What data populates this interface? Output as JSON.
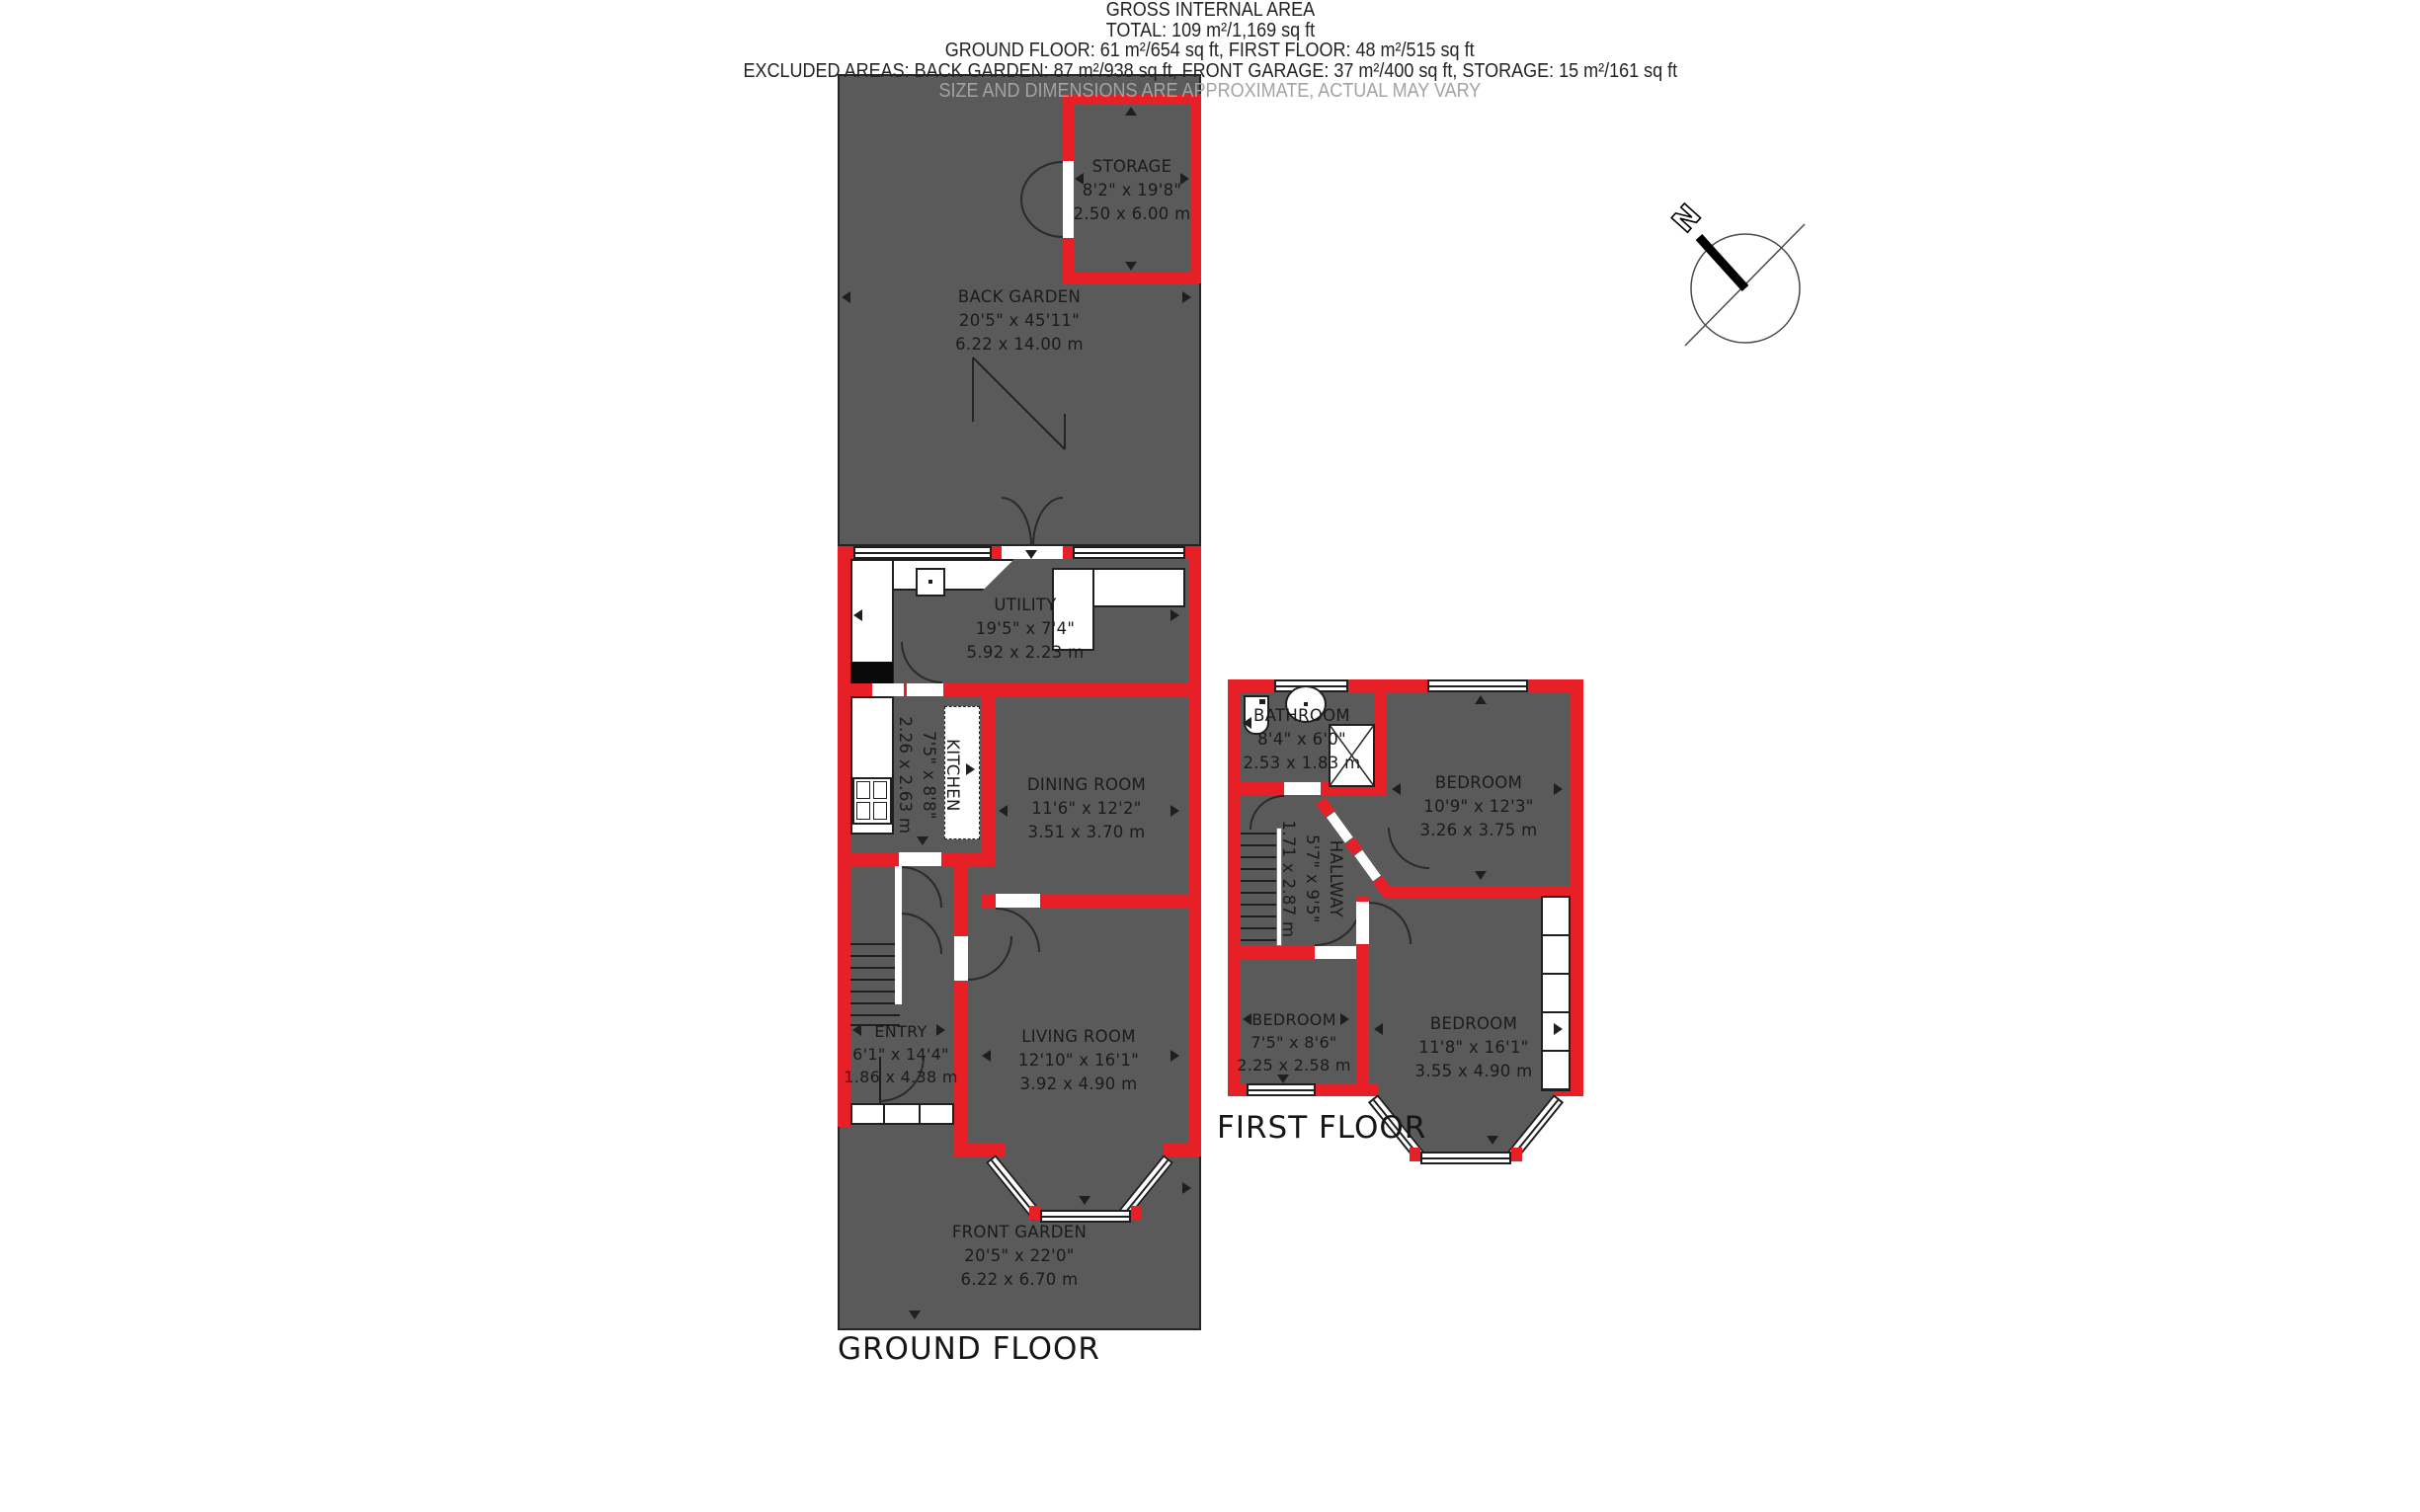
{
  "titles": {
    "ground_floor": "GROUND FLOOR",
    "first_floor": "FIRST FLOOR"
  },
  "compass": {
    "north_label": "N"
  },
  "rooms": {
    "back_garden": {
      "name": "BACK GARDEN",
      "imperial": "20'5\" x 45'11\"",
      "metric": "6.22 x 14.00 m"
    },
    "storage": {
      "name": "STORAGE",
      "imperial": "8'2\" x 19'8\"",
      "metric": "2.50 x 6.00 m"
    },
    "utility": {
      "name": "UTILITY",
      "imperial": "19'5\" x 7'4\"",
      "metric": "5.92 x 2.23 m"
    },
    "kitchen": {
      "name": "KITCHEN",
      "imperial": "7'5\" x 8'8\"",
      "metric": "2.26 x 2.63 m"
    },
    "dining_room": {
      "name": "DINING ROOM",
      "imperial": "11'6\" x 12'2\"",
      "metric": "3.51 x 3.70 m"
    },
    "entry": {
      "name": "ENTRY",
      "imperial": "6'1\" x 14'4\"",
      "metric": "1.86 x 4.38 m"
    },
    "living_room": {
      "name": "LIVING ROOM",
      "imperial": "12'10\" x 16'1\"",
      "metric": "3.92 x 4.90 m"
    },
    "front_garden": {
      "name": "FRONT GARDEN",
      "imperial": "20'5\" x 22'0\"",
      "metric": "6.22 x 6.70 m"
    },
    "bathroom": {
      "name": "BATHROOM",
      "imperial": "8'4\" x 6'0\"",
      "metric": "2.53 x 1.83 m"
    },
    "bedroom_1": {
      "name": "BEDROOM",
      "imperial": "10'9\" x 12'3\"",
      "metric": "3.26 x 3.75 m"
    },
    "hallway": {
      "name": "HALLWAY",
      "imperial": "5'7\" x 9'5\"",
      "metric": "1.71 x 2.87 m"
    },
    "bedroom_2": {
      "name": "BEDROOM",
      "imperial": "7'5\" x 8'6\"",
      "metric": "2.25 x 2.58 m"
    },
    "bedroom_3": {
      "name": "BEDROOM",
      "imperial": "11'8\" x 16'1\"",
      "metric": "3.55 x 4.90 m"
    }
  },
  "footer": {
    "heading": "GROSS INTERNAL AREA",
    "total": "TOTAL: 109 m²/1,169 sq ft",
    "floors": "GROUND FLOOR: 61 m²/654 sq ft, FIRST FLOOR: 48 m²/515 sq ft",
    "excluded": "EXCLUDED AREAS: BACK GARDEN: 87 m²/938 sq ft, FRONT GARAGE: 37 m²/400 sq ft, STORAGE: 15 m²/161 sq ft",
    "disclaimer": "SIZE AND DIMENSIONS ARE APPROXIMATE, ACTUAL MAY VARY"
  },
  "colors": {
    "wall": "#e71f27",
    "room_fill": "#5a5a5a",
    "outline": "#1f1f1f",
    "disclaimer_text": "#a3a3a3"
  }
}
